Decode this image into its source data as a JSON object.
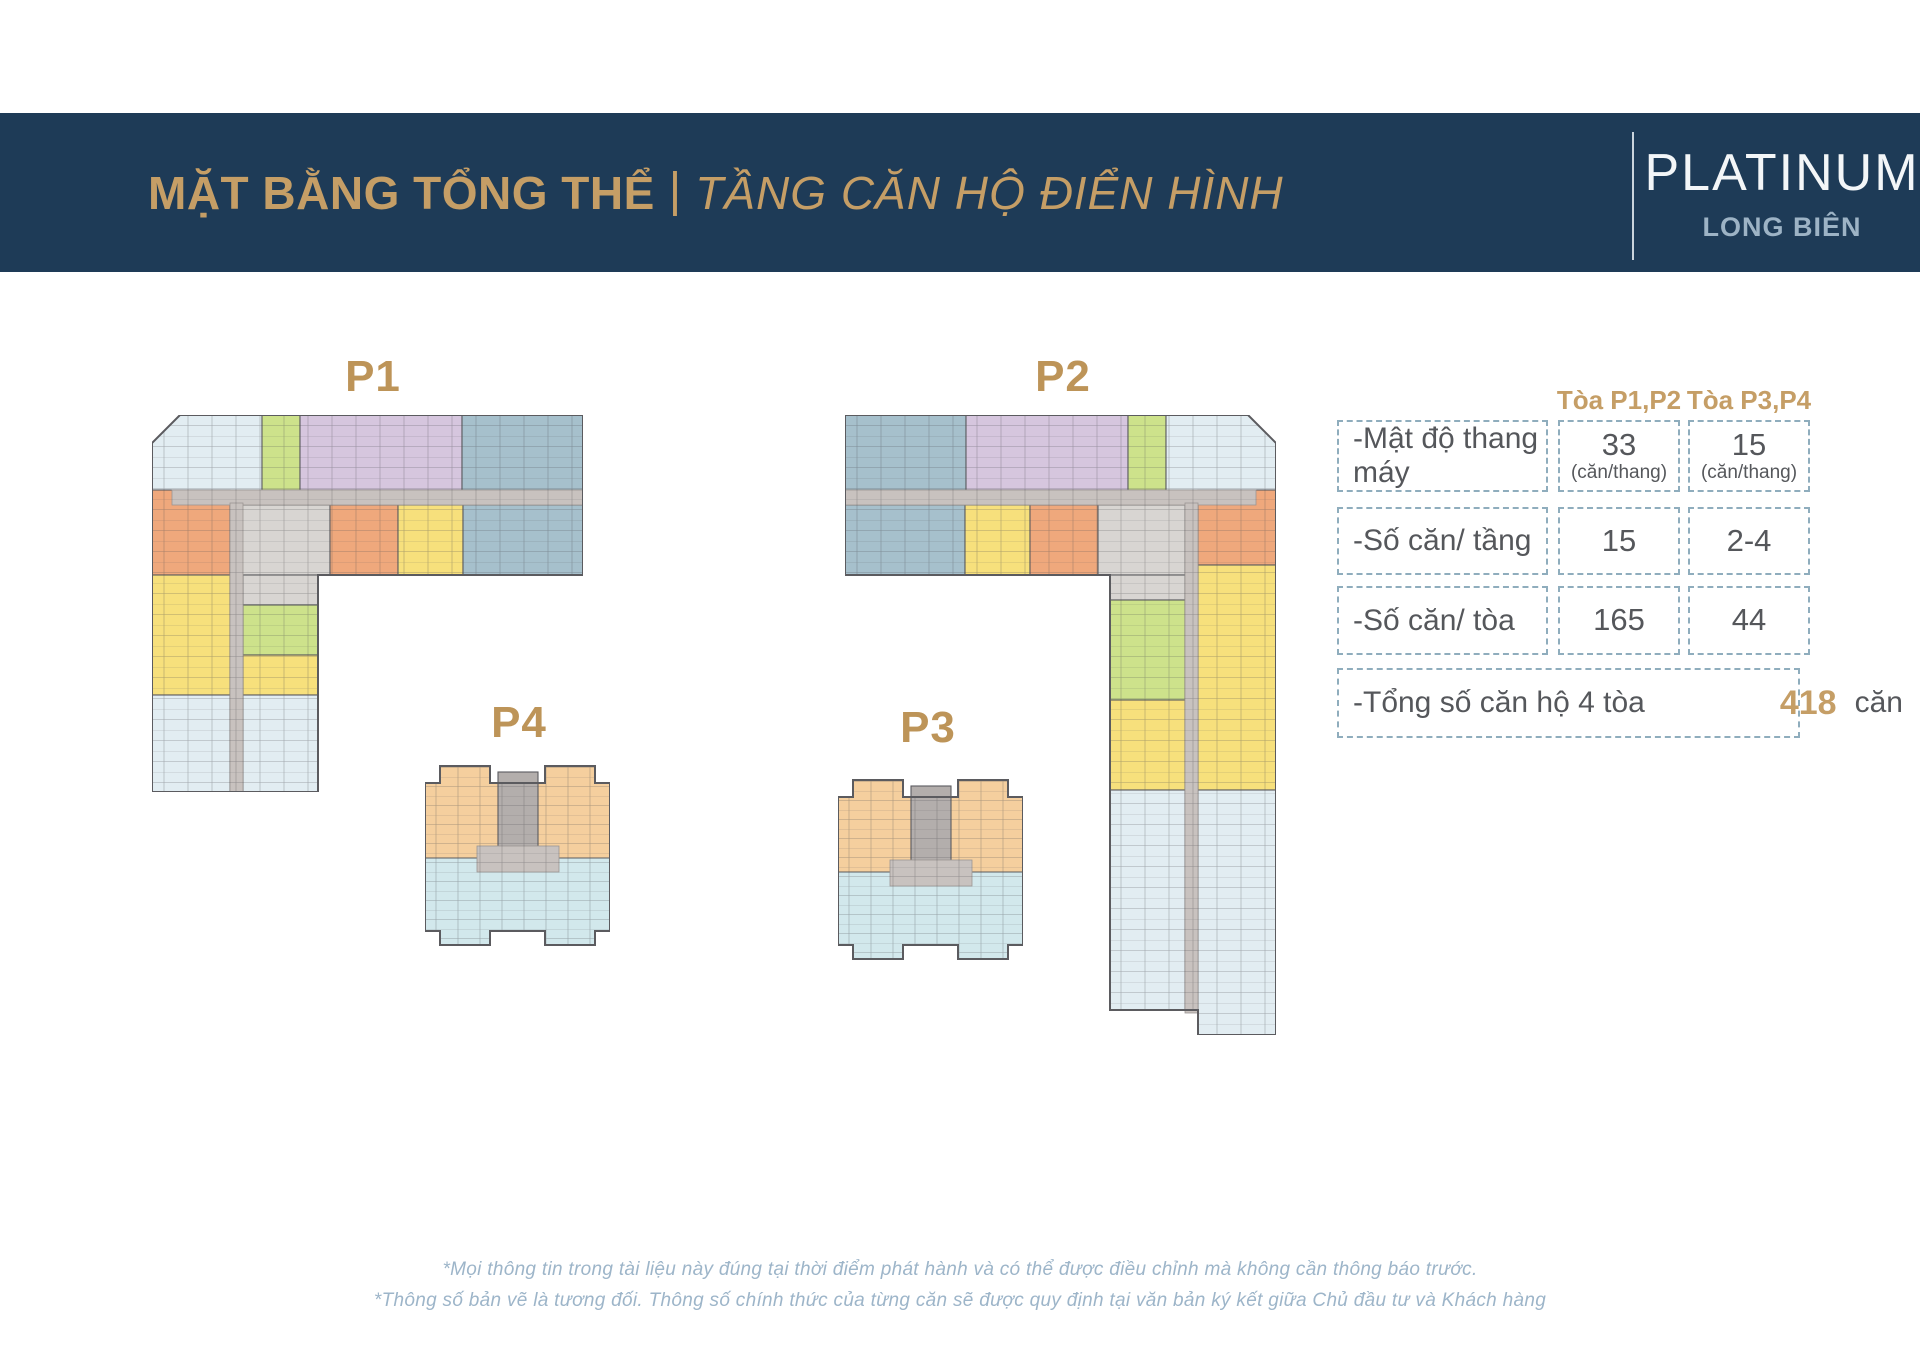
{
  "header": {
    "title_bold": "MẶT BẰNG TỔNG THỂ",
    "title_sep": "|",
    "title_italic": "TẦNG CĂN HỘ ĐIỂN HÌNH",
    "brand_name": "PLATINUM",
    "brand_sub": "LONG BIÊN"
  },
  "buildings": [
    {
      "id": "p1",
      "label": "P1",
      "type": "L-shaped tower plan"
    },
    {
      "id": "p2",
      "label": "P2",
      "type": "L-shaped tower plan (mirrored)"
    },
    {
      "id": "p4",
      "label": "P4",
      "type": "compact tower plan"
    },
    {
      "id": "p3",
      "label": "P3",
      "type": "compact tower plan"
    }
  ],
  "table": {
    "col_headers": [
      "Tòa P1,P2",
      "Tòa P3,P4"
    ],
    "rows": [
      {
        "label": "-Mật độ thang máy",
        "v1": "33",
        "v1_sub": "(căn/thang)",
        "v2": "15",
        "v2_sub": "(căn/thang)"
      },
      {
        "label": "-Số căn/ tầng",
        "v1": "15",
        "v2": "2-4"
      },
      {
        "label": "-Số căn/ tòa",
        "v1": "165",
        "v2": "44"
      }
    ],
    "total": {
      "label": "-Tổng số căn hộ 4 tòa",
      "value": "418",
      "unit": "căn"
    }
  },
  "footer": {
    "line1": "*Mọi thông tin trong tài liệu này đúng tại thời điểm phát hành và có thể được điều chỉnh mà không cần thông báo trước.",
    "line2": "*Thông số bản vẽ là tương đối. Thông số chính thức của từng căn sẽ được quy định tại văn bản ký kết giữa Chủ đầu tư và Khách hàng"
  },
  "colors": {
    "navy": "#1e3b57",
    "gold": "#c59e66",
    "gold_dark": "#bd9458",
    "white_text": "#f3f6f8",
    "brand_sub": "#9db3c5",
    "table_text": "#55575b",
    "dash": "#8fadbd",
    "footer": "#9db5c9",
    "lightblue": "#e2edf2",
    "green": "#cde28b",
    "purple": "#d6c6de",
    "slate": "#a6c0cc",
    "orange": "#efa87c",
    "yellow": "#f7e07c",
    "peach": "#f5cf9e",
    "cyan": "#d2e8ec",
    "corridor": "#c8c2bf",
    "utility": "#d8d5d2",
    "core": "#b3aeac",
    "wall": "#5b5b5f"
  }
}
